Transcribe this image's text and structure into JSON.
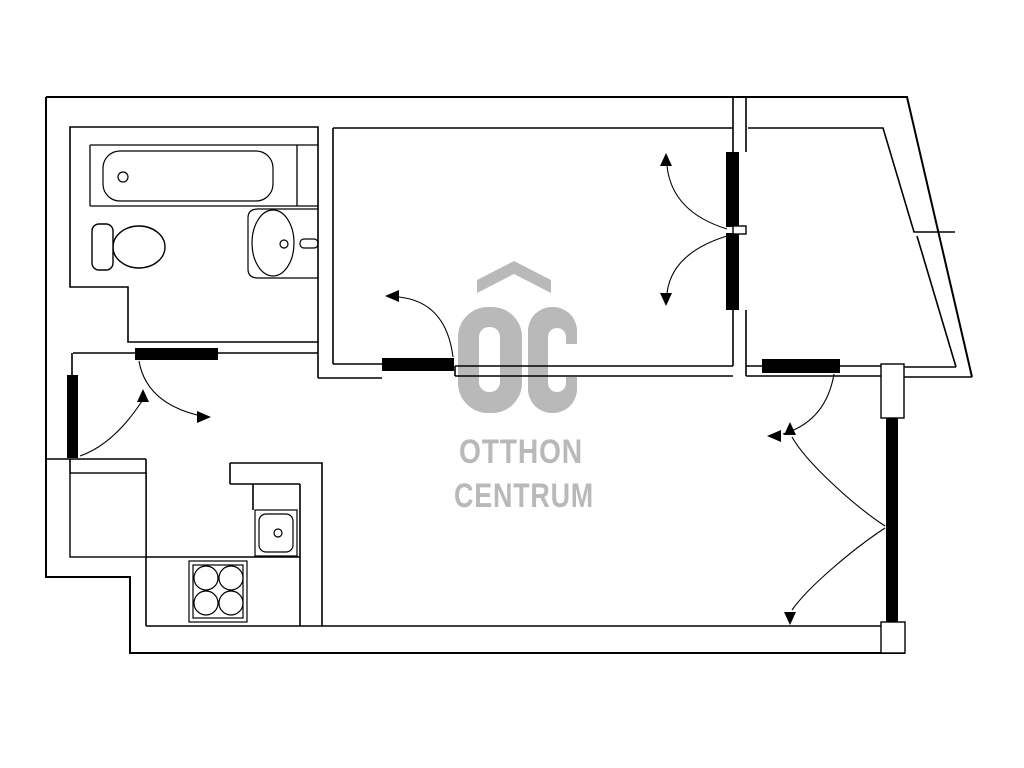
{
  "document": {
    "background": "#ffffff",
    "kind_label": "apartment floor plan"
  },
  "watermark": {
    "monogram": "OC",
    "word1": "OTTHON",
    "word2": "CENTRUM",
    "color": "#b9b9b9"
  },
  "plan": {
    "line_color": "#000000",
    "wall_fill_color": "#000000",
    "fixture_icons": [
      "bathtub-icon",
      "toilet-icon",
      "washbasin-icon",
      "kitchen-sink-icon",
      "stove-icon",
      "kitchen-cabinet-icon"
    ],
    "door_icons": [
      "entry-door-icon",
      "bathroom-door-icon",
      "middle-room-door-icon",
      "double-swing-door-icon",
      "living-room-door-icon",
      "balcony-double-door-icon"
    ]
  }
}
